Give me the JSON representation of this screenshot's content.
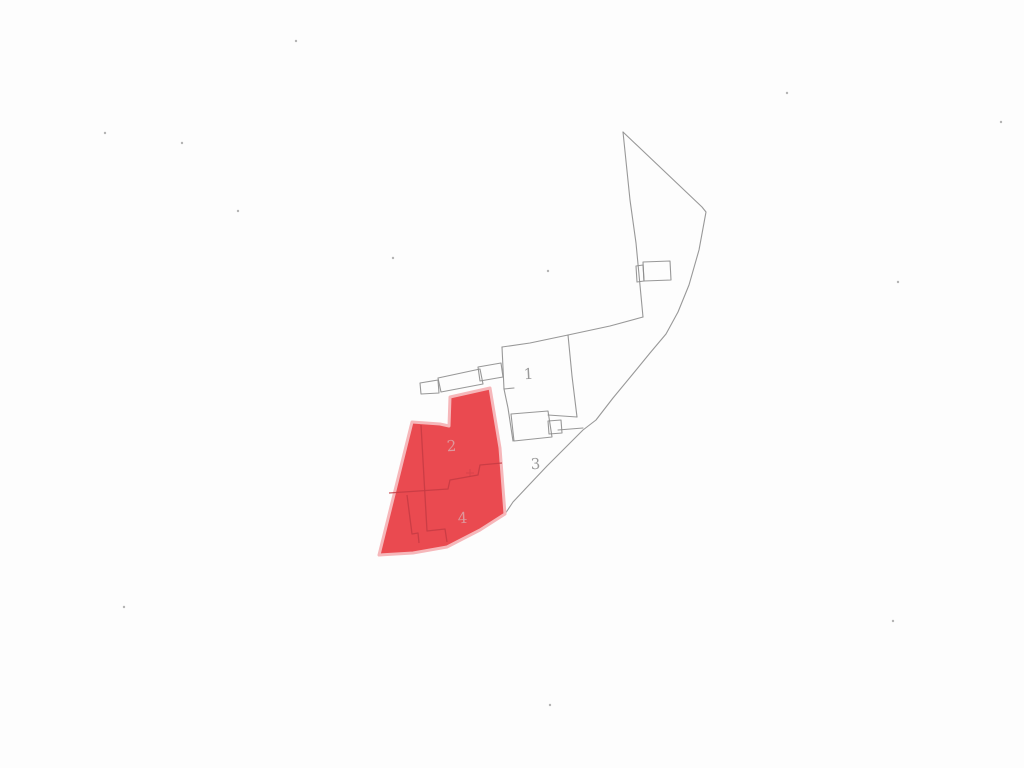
{
  "document": {
    "title": "cadastral-parcel-plan-scan",
    "background": "#fdfdfd",
    "line_color": "#8d8d8d",
    "highlight_fill": "#ea4a50",
    "highlight_edge": "#f6b7ba",
    "internal_line_color": "#c53b43",
    "label_color_plain": "#9a9a9a",
    "label_color_on_highlight": "#de989c"
  },
  "parcels": [
    {
      "id": "1",
      "label": "1",
      "x": 529,
      "y": 379,
      "highlighted": false
    },
    {
      "id": "2",
      "label": "2",
      "x": 452,
      "y": 451,
      "highlighted": true
    },
    {
      "id": "3",
      "label": "3",
      "x": 536,
      "y": 469,
      "highlighted": false
    },
    {
      "id": "4",
      "label": "4",
      "x": 463,
      "y": 523,
      "highlighted": true
    }
  ],
  "highlight_polygon": {
    "name": "highlighted-parcels-2-4",
    "points": [
      [
        490,
        388
      ],
      [
        500,
        448
      ],
      [
        505,
        514
      ],
      [
        480,
        530
      ],
      [
        447,
        547
      ],
      [
        413,
        553
      ],
      [
        379,
        555
      ],
      [
        412,
        422
      ],
      [
        440,
        424
      ],
      [
        449,
        426
      ],
      [
        450,
        397
      ]
    ]
  },
  "outline_paths": [
    {
      "name": "outer-boundary-right",
      "points": [
        [
          623,
          132
        ],
        [
          702,
          207
        ],
        [
          706,
          212
        ],
        [
          699,
          250
        ],
        [
          689,
          285
        ],
        [
          678,
          312
        ],
        [
          666,
          334
        ],
        [
          650,
          353
        ],
        [
          632,
          375
        ],
        [
          613,
          398
        ],
        [
          596,
          420
        ],
        [
          583,
          430
        ],
        [
          565,
          448
        ],
        [
          547,
          466
        ],
        [
          529,
          485
        ],
        [
          513,
          502
        ],
        [
          505,
          514
        ]
      ]
    },
    {
      "name": "outer-boundary-left",
      "points": [
        [
          623,
          132
        ],
        [
          630,
          200
        ],
        [
          636,
          243
        ],
        [
          643,
          317
        ]
      ]
    },
    {
      "name": "block-top-line",
      "points": [
        [
          643,
          317
        ],
        [
          610,
          326
        ],
        [
          568,
          335
        ],
        [
          530,
          343
        ],
        [
          502,
          347
        ]
      ]
    },
    {
      "name": "block-left-edge",
      "points": [
        [
          502,
          347
        ],
        [
          504,
          389
        ],
        [
          508,
          408
        ],
        [
          513,
          441
        ]
      ]
    },
    {
      "name": "left-edge-tick",
      "points": [
        [
          504,
          389
        ],
        [
          514,
          388
        ]
      ]
    },
    {
      "name": "parcel1-right-edge",
      "points": [
        [
          568,
          335
        ],
        [
          572,
          376
        ],
        [
          577,
          417
        ]
      ]
    },
    {
      "name": "parcel1-bottom-edge",
      "points": [
        [
          548,
          415
        ],
        [
          577,
          417
        ]
      ]
    },
    {
      "name": "lower-building-rect",
      "points": [
        [
          511,
          414
        ],
        [
          548,
          411
        ],
        [
          552,
          437
        ],
        [
          514,
          441
        ],
        [
          511,
          414
        ]
      ]
    },
    {
      "name": "lower-building-annex",
      "points": [
        [
          548,
          421
        ],
        [
          561,
          420
        ],
        [
          562,
          433
        ],
        [
          549,
          434
        ],
        [
          548,
          421
        ]
      ]
    },
    {
      "name": "connector-line",
      "points": [
        [
          558,
          430
        ],
        [
          583,
          428
        ]
      ]
    },
    {
      "name": "upper-building-rect",
      "points": [
        [
          643,
          262
        ],
        [
          670,
          261
        ],
        [
          671,
          280
        ],
        [
          644,
          281
        ],
        [
          643,
          262
        ]
      ]
    },
    {
      "name": "upper-building-annex",
      "points": [
        [
          636,
          266
        ],
        [
          643,
          265
        ],
        [
          644,
          281
        ],
        [
          637,
          282
        ],
        [
          636,
          266
        ]
      ]
    },
    {
      "name": "mid-building-rect",
      "points": [
        [
          438,
          378
        ],
        [
          480,
          369
        ],
        [
          483,
          384
        ],
        [
          441,
          392
        ],
        [
          438,
          378
        ]
      ]
    },
    {
      "name": "mid-building-annex",
      "points": [
        [
          478,
          367
        ],
        [
          501,
          363
        ],
        [
          503,
          377
        ],
        [
          480,
          381
        ],
        [
          478,
          367
        ]
      ]
    },
    {
      "name": "mid-building-tab",
      "points": [
        [
          420,
          383
        ],
        [
          438,
          380
        ],
        [
          439,
          393
        ],
        [
          421,
          394
        ],
        [
          420,
          383
        ]
      ]
    }
  ],
  "internal_paths": [
    {
      "name": "divider-vertical",
      "points": [
        [
          421,
          425
        ],
        [
          427,
          531
        ],
        [
          445,
          529
        ],
        [
          447,
          542
        ]
      ]
    },
    {
      "name": "divider-2-4-staircase",
      "points": [
        [
          389,
          493
        ],
        [
          448,
          489
        ],
        [
          450,
          480
        ],
        [
          478,
          475
        ],
        [
          480,
          465
        ],
        [
          502,
          463
        ]
      ]
    },
    {
      "name": "divider-bottom-hook",
      "points": [
        [
          407,
          495
        ],
        [
          412,
          534
        ],
        [
          418,
          533
        ],
        [
          419,
          543
        ]
      ]
    }
  ],
  "survey_cross": {
    "x": 470,
    "y": 473
  },
  "noise_specks": [
    {
      "x": 182,
      "y": 143
    },
    {
      "x": 296,
      "y": 41
    },
    {
      "x": 393,
      "y": 258
    },
    {
      "x": 548,
      "y": 271
    },
    {
      "x": 787,
      "y": 93
    },
    {
      "x": 1001,
      "y": 122
    },
    {
      "x": 550,
      "y": 705
    },
    {
      "x": 898,
      "y": 282
    },
    {
      "x": 238,
      "y": 211
    },
    {
      "x": 124,
      "y": 607
    },
    {
      "x": 893,
      "y": 621
    },
    {
      "x": 105,
      "y": 133
    }
  ]
}
